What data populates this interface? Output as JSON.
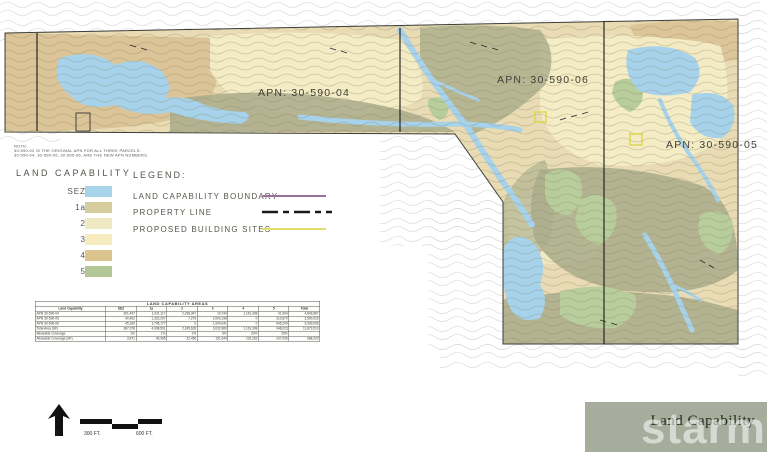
{
  "map": {
    "apn_labels": [
      {
        "text": "APN: 30-590-04"
      },
      {
        "text": "APN: 30-590-06"
      },
      {
        "text": "APN: 30-590-05"
      }
    ],
    "colors": {
      "base": "#e9dcb4",
      "contour": "#8d8260",
      "sez_blue": "#a6d2ec",
      "olive": "#a9ac8b",
      "tan": "#d9c193",
      "pale_yellow": "#f3ecc6",
      "green": "#b7cd9b",
      "building_site_yellow": "#ddd64a",
      "boundary_black": "#1a1a1a"
    }
  },
  "note": {
    "title": "NOTE:",
    "lines": [
      "30-590-02 IS THE ORIGINAL APN FOR ALL THREE PARCELS.",
      "30-590-04, 30-590-05, 30-590-06, ARE THE NEW APN NUMBERS."
    ]
  },
  "capability_key": {
    "title": "LAND CAPABILITY",
    "items": [
      {
        "label": "SEZ",
        "color": "#a8d3e9"
      },
      {
        "label": "1a",
        "color": "#d5cd9e"
      },
      {
        "label": "2",
        "color": "#eee9c3"
      },
      {
        "label": "3",
        "color": "#f6ecc0"
      },
      {
        "label": "4",
        "color": "#dcc48f"
      },
      {
        "label": "5",
        "color": "#b2c795"
      }
    ]
  },
  "legend": {
    "title": "LEGEND:",
    "items": [
      {
        "label": "LAND CAPABILITY BOUNDARY",
        "color": "#9a719a",
        "style": "solid"
      },
      {
        "label": "PROPERTY LINE",
        "color": "#1a1a1a",
        "style": "dash-dot"
      },
      {
        "label": "PROPOSED BUILDING SITES",
        "color": "#e3dd6b",
        "style": "solid"
      }
    ]
  },
  "table": {
    "title": "LAND CAPABILITY AREAS",
    "columns": [
      "Land Capability",
      "SEZ",
      "1a",
      "2",
      "3",
      "4",
      "5",
      "Total"
    ],
    "rows": [
      {
        "label": "APN 30-590-04",
        "values": [
          "301,447",
          "1,031,117",
          "2,238,347",
          "19,744",
          "1,161,308",
          "91,904",
          "4,843,867"
        ]
      },
      {
        "label": "APN 30-590-05",
        "values": [
          "40,462",
          "1,322,207",
          "7,279",
          "2,009,198",
          "0",
          "210,870",
          "3,590,016"
        ]
      },
      {
        "label": "APN 30-590-06",
        "values": [
          "45,169",
          "1,745,177",
          "0",
          "1,004,041",
          "0",
          "645,249",
          "3,439,636"
        ]
      },
      {
        "label": "Total Area (SF)",
        "values": [
          "387,078",
          "4,098,501",
          "2,245,626",
          "3,032,983",
          "1,161,308",
          "948,023",
          "11,873,519"
        ]
      },
      {
        "label": "Allowable Coverage",
        "values": [
          "1%",
          "1%",
          "1%",
          "5%",
          "20%",
          "25%",
          ""
        ]
      },
      {
        "label": "Allowable Coverage (SF)",
        "values": [
          "3,871",
          "40,985",
          "22,456",
          "151,649",
          "232,262",
          "237,006",
          "688,229"
        ]
      }
    ]
  },
  "scale_bar": {
    "labels": [
      "0",
      "300 FT.",
      "600 FT."
    ]
  },
  "footer": {
    "title": "Land Capability",
    "background": "#a6ad9c"
  },
  "watermark": {
    "text": "starmls"
  }
}
